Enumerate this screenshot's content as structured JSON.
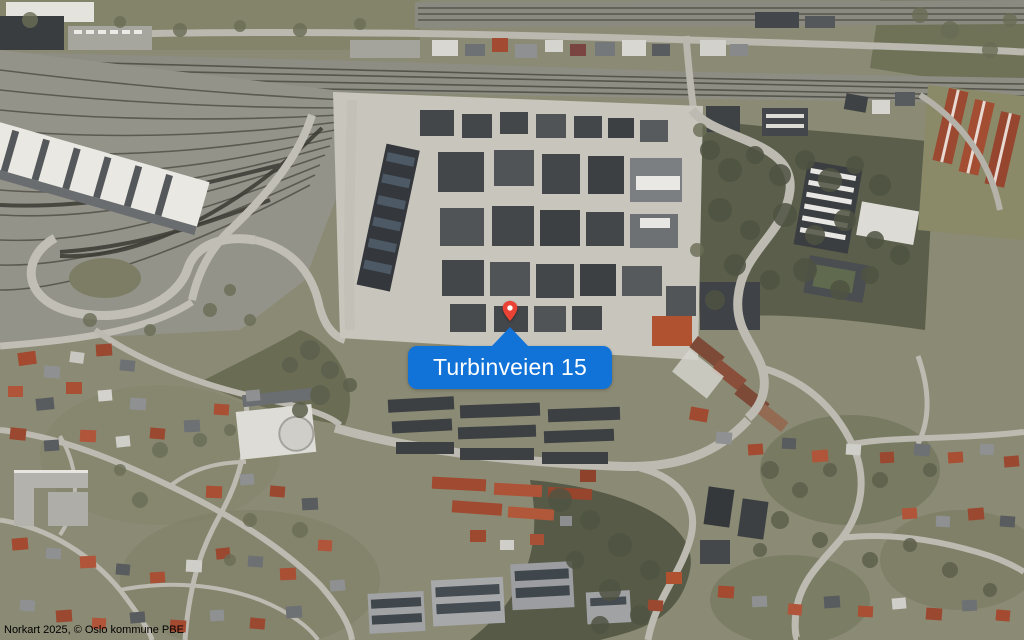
{
  "map": {
    "location_label": "Turbinveien 15",
    "attribution": "Norkart 2025, © Oslo kommune PBE",
    "colors": {
      "pin": "#ea4335",
      "pin_dot": "#ffffff",
      "callout_bg": "#1172d8",
      "callout_text": "#ffffff",
      "attribution_text": "#000000"
    }
  }
}
